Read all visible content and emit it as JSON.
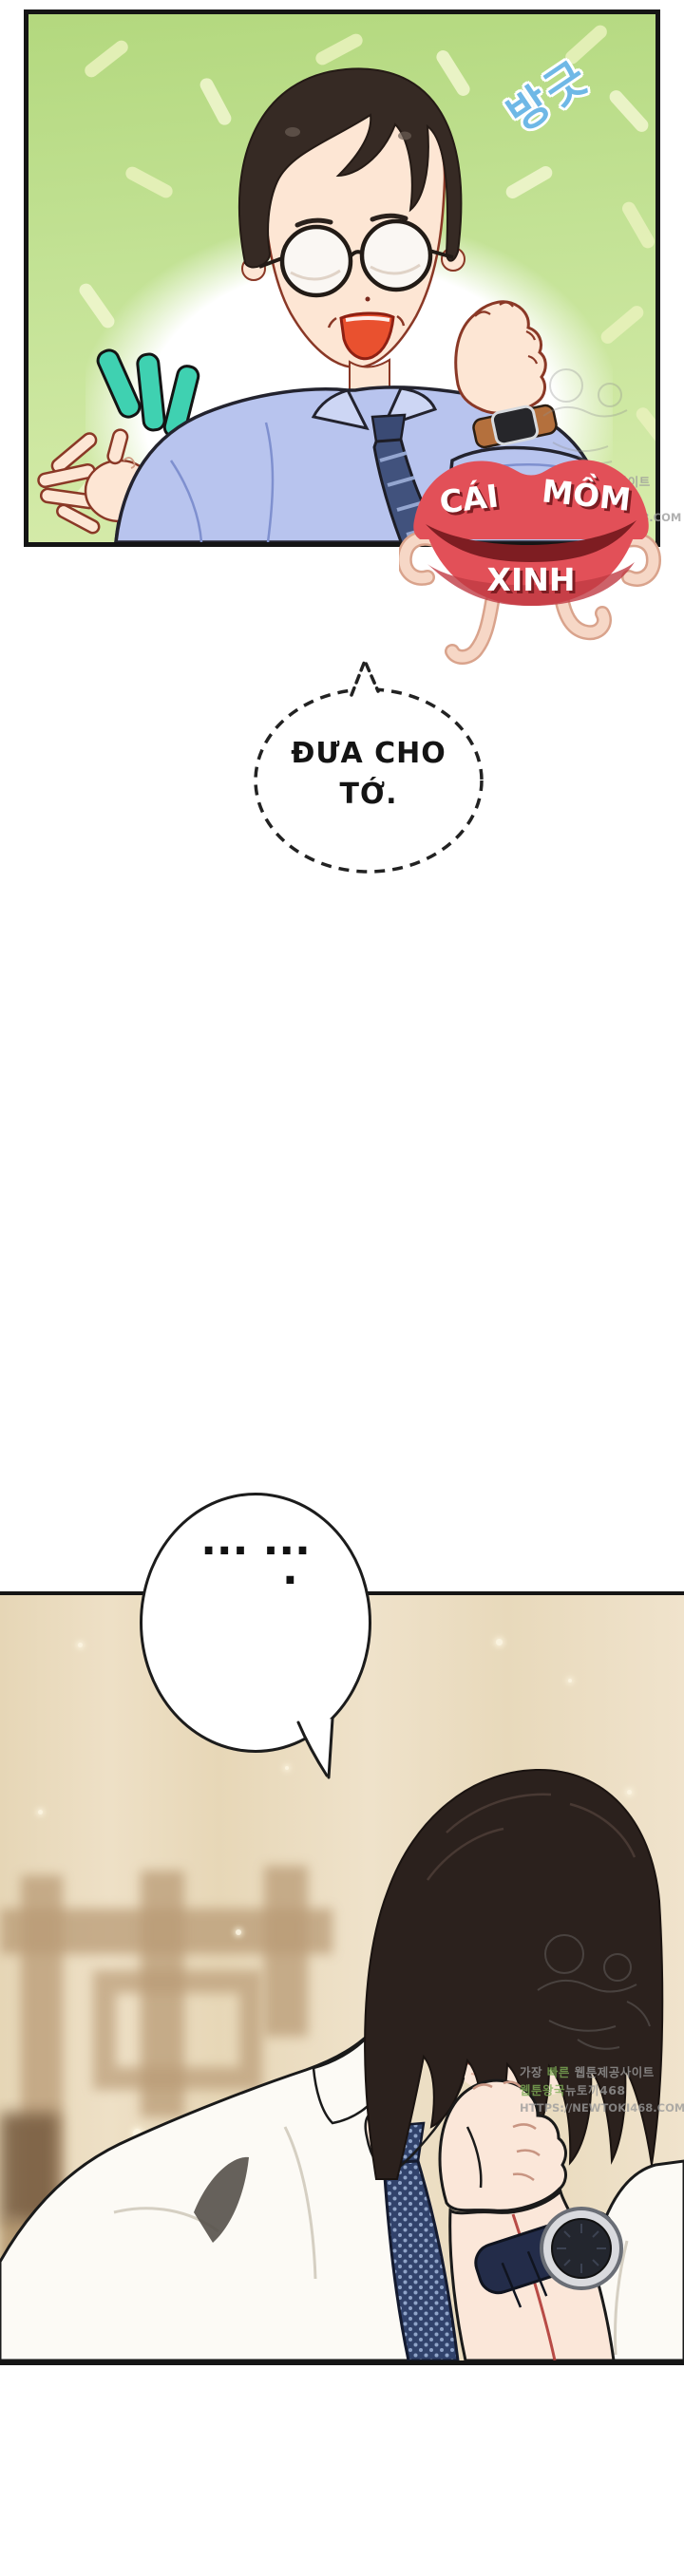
{
  "panel1": {
    "sfx_text": "방긋",
    "colors": {
      "bg_top": "#b3d87e",
      "bg_bottom": "#d7ecac",
      "border": "#151515",
      "confetti": "#e7f1ba",
      "glow": "#ffffff",
      "sfx_fill": "#6fb8e6",
      "sfx_outline": "#ffffff",
      "emphasis_marks": "#3fd1b1",
      "skin": "#fde6d4",
      "skin_line": "#8a3826",
      "hair": "#362a24",
      "shirt": "#b8c4ee",
      "collar": "#cdd6f4",
      "tie": "#41527d",
      "tie_stripe": "#94a6d0",
      "mouth": "#e9512f",
      "glasses": "#faf8f4",
      "watch_strap": "#b4703d",
      "watch_face": "#26262a"
    }
  },
  "sticker": {
    "text_top": "CÁI MỒM",
    "text_bottom": "XINH",
    "colors": {
      "lip": "#e25058",
      "lip_opening": "#7e1d22",
      "lip_shadow": "#c13b44",
      "text": "#ffffff",
      "text_shadow": "#7e1d22",
      "limb": "#f6d7c6",
      "limb_line": "#d9a38c"
    }
  },
  "bubble1": {
    "line1": "ĐƯA CHO",
    "line2": "TỚ.",
    "text_color": "#141414",
    "border_color": "#222222",
    "style": "dashed"
  },
  "bubble2": {
    "dots": "··· ···",
    "period": ".",
    "border_color": "#1c1c1c"
  },
  "panel2": {
    "colors": {
      "bg": "#e9dcc0",
      "lattice": "#b99b76",
      "border": "#151515",
      "hair": "#2b211d",
      "skin": "#fbe7d9",
      "skin_shadow": "#f3c9b4",
      "shirt": "#fcfaf5",
      "shirt_fold": "#d5cfc2",
      "tie": "#31426b",
      "tie_dot": "#8fa3c8",
      "watch_strap": "#232c49",
      "watch_bezel": "#d9dade",
      "watch_face": "#23262e",
      "cord": "#b03a35",
      "eye_iris": "#8a8f94",
      "sparkle": "#fdf6e3"
    }
  },
  "watermark": {
    "l1a": "가장 ",
    "l1b": "빠른",
    "l1c": " 웹툰제공사이트",
    "l2a": "웹툰왕국",
    "l2b": "뉴토끼468",
    "l3": "HTTPS://NEWTOKI468.COM",
    "color": "#9b9b9b",
    "highlight_color": "#7fae57"
  }
}
